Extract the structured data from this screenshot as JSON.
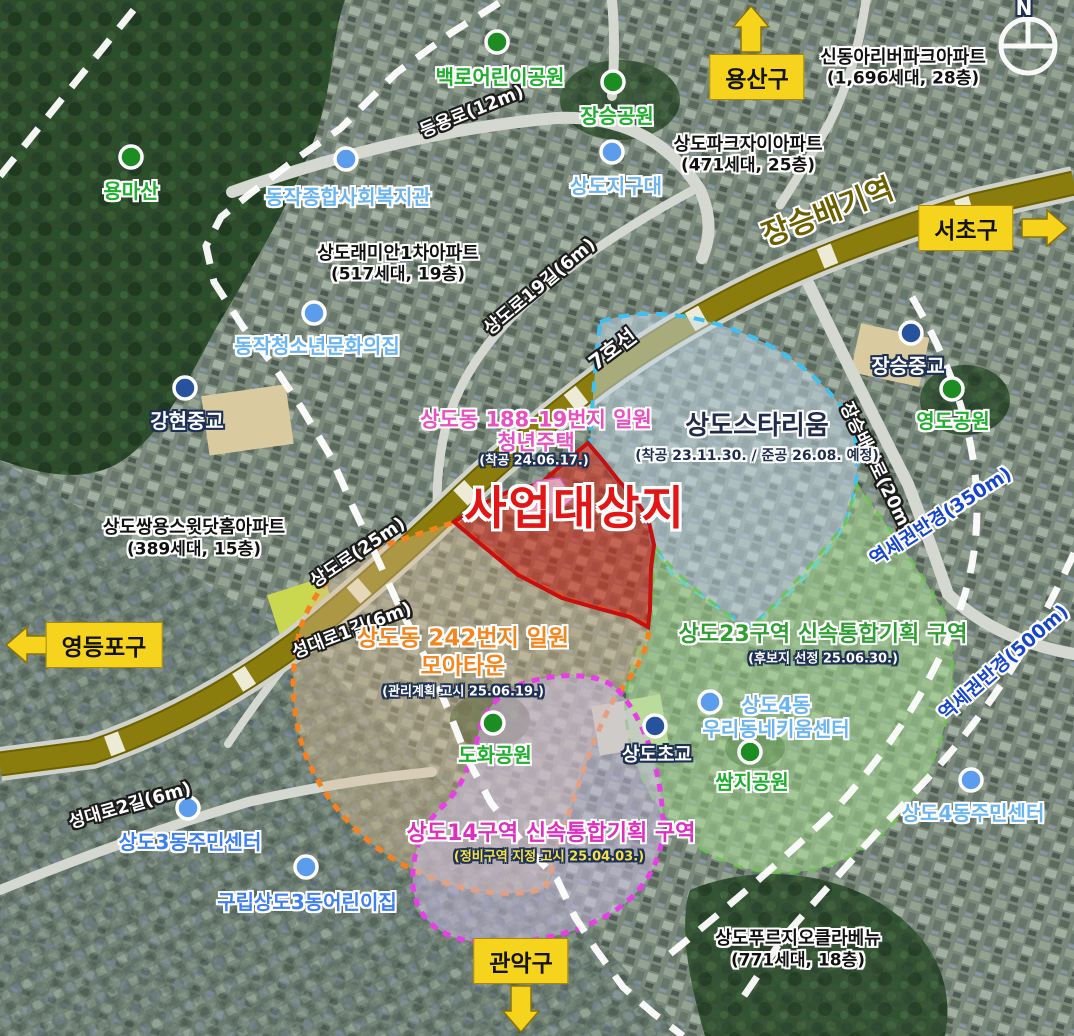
{
  "map": {
    "compass_north": "N",
    "districts": {
      "yongsan": "용산구",
      "seocho": "서초구",
      "yeongdeungpo": "영등포구",
      "gwanak": "관악구"
    },
    "transit": {
      "station": "장승배기역",
      "line": "7호선"
    },
    "roads": {
      "deungyong": "등용로(12m)",
      "sangdoro19": "상도로19길(6m)",
      "sangdoro": "상도로(25m)",
      "seongdae1": "성대로1길(6m)",
      "seongdae2": "성대로2길(6m)",
      "jangseungbaegi": "장승배기로(20m)"
    },
    "radius": {
      "r350": "역세권반경(350m)",
      "r500": "역세권반경(500m)"
    },
    "zones": {
      "youth": {
        "line1": "상도동 188-19번지 일원",
        "line2": "청년주택",
        "note": "(착공 24.06.17.)",
        "site": "사업대상지"
      },
      "starium": {
        "name": "상도스타리움",
        "note": "(착공 23.11.30. / 준공 26.08. 예정)"
      },
      "moatown": {
        "line1": "상도동 242번지 일원",
        "line2": "모아타운",
        "note": "(관리계획 고시 25.06.19.)"
      },
      "sangdo23": {
        "name": "상도23구역 신속통합기획 구역",
        "note": "(후보지 선정 25.06.30.)"
      },
      "sangdo14": {
        "name": "상도14구역 신속통합기획 구역",
        "note": "(정비구역 지정 고시 25.04.03.)"
      }
    },
    "parks": {
      "baekro": "백로어린이공원",
      "jangseung": "장승공원",
      "yongma": "용마산",
      "yeongdo": "영도공원",
      "dohwa": "도화공원",
      "ssamji": "쌈지공원"
    },
    "facilities": {
      "jigudae": "상도지구대",
      "welfare": "동작종합사회복지관",
      "youthculture": "동작청소년문화의집",
      "kium1": "상도4동",
      "kium2": "우리동네키움센터",
      "sd3center": "상도3동주민센터",
      "sd3daycare": "구립상도3동어린이집",
      "sd4center": "상도4동주민센터"
    },
    "schools": {
      "ganghyeon": "강현중교",
      "jangseungjung": "장승중교",
      "sangdocho": "상도초교"
    },
    "apartments": {
      "shindonga": {
        "name": "신동아리버파크아파트",
        "detail": "(1,696세대, 28층)"
      },
      "parkxi": {
        "name": "상도파크자이아파트",
        "detail": "(471세대, 25층)"
      },
      "raemian": {
        "name": "상도래미안1차아파트",
        "detail": "(517세대, 19층)"
      },
      "ssangyong": {
        "name": "상도쌍용스윗닷홈아파트",
        "detail": "(389세대, 15층)"
      },
      "prugio": {
        "name": "상도푸르지오클라베뉴",
        "detail": "(771세대, 18층)"
      }
    },
    "colors": {
      "district_box": "#f6d41e",
      "site_red": "#e31616",
      "zone_blue": "#3fc0f2",
      "zone_orange": "#f5821e",
      "zone_magenta": "#e83ee8",
      "zone_green": "#6cc44e",
      "subway_band": "#8a7d0e"
    }
  }
}
